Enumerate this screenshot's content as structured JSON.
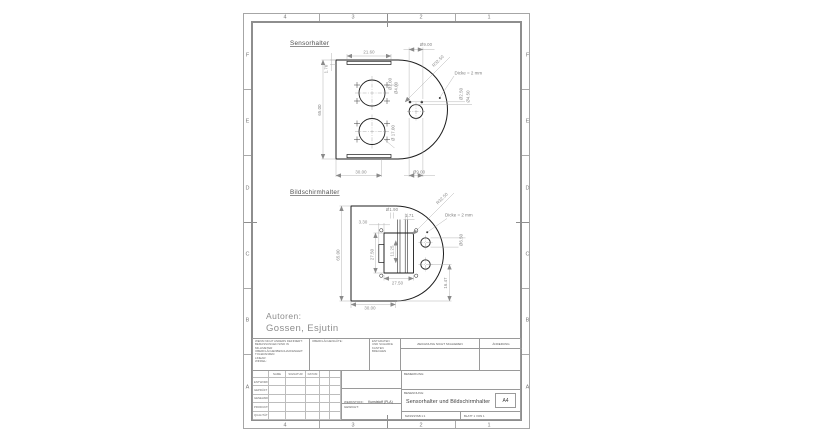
{
  "sheet": {
    "zone_columns": [
      "4",
      "3",
      "2",
      "1"
    ],
    "zone_rows": [
      "F",
      "E",
      "D",
      "C",
      "B",
      "A"
    ]
  },
  "authors": {
    "label": "Autoren:",
    "names": "Gossen, Esjutin"
  },
  "views": {
    "sensorhalter": {
      "label": "Sensorhalter",
      "thickness_note": "Dicke = 2 mm",
      "dims": {
        "top_width": "21.60",
        "tab_height": "1.70",
        "height": "65.00",
        "top_hole": "Ø9.00",
        "radius": "R32.50",
        "big_hole": "Ø 17.00",
        "small_hole": "Ø2.00",
        "small_hole_2": "Ø4.00",
        "pin_small": "Ø2.50",
        "pin_large": "Ø4.50",
        "bottom_width": "30.00",
        "bottom_hole": "Ø9.00"
      }
    },
    "bildschirmhalter": {
      "label": "Bildschirmhalter",
      "thickness_note": "Dicke = 2 mm",
      "dims": {
        "slot_width": "Ø1.90",
        "notch_offset": "3.30",
        "slot_gap": "1.71",
        "radius": "R32.50",
        "height": "65.00",
        "window_height": "27.50",
        "notch_height": "11.25",
        "window_width": "27.50",
        "base_width": "30.00",
        "hole_spacing": "16.47",
        "hole_dia": "Ø6.50"
      }
    }
  },
  "title_block": {
    "tolerance_note": "WENN NICHT ANDERS DEFINIERT:\nBEMASSUNGEN SIND IN MILLIMETER\nOBERFLÄCHENBESCHAFFENHEIT:\nTOLERANZEN:\n   LINEAR:\n   WINKEL:",
    "surface_label": "OBERFLÄCHENGÜTE:",
    "deburr_note": "ENTGRATEN\nUND SCHARFE\nKANTEN\nBRECHEN",
    "no_scale_note": "ZEICHNUNG NICHT SKALIEREN",
    "revision_label": "ÄNDERUNG",
    "columns": {
      "name": "NAME",
      "signature": "SIGNATUR",
      "date": "DATUM"
    },
    "rows": [
      "ENTWORFEN",
      "GEPRÜFT",
      "GENEHMIGT",
      "PRODUKTION",
      "QUALITÄT"
    ],
    "comment_label": "BEMERKUNG:",
    "material_label": "WERKSTOFF:",
    "material_value": "Kunststoff (PLA)",
    "weight_label": "GEWICHT:",
    "title_label": "BENENNUNG:",
    "title_value": "Sensorhalter und Bildschirmhalter",
    "scale_label": "MASSSTAB:1:1",
    "sheet_label": "BLATT 1 VON 1",
    "paper_size": "A4"
  }
}
